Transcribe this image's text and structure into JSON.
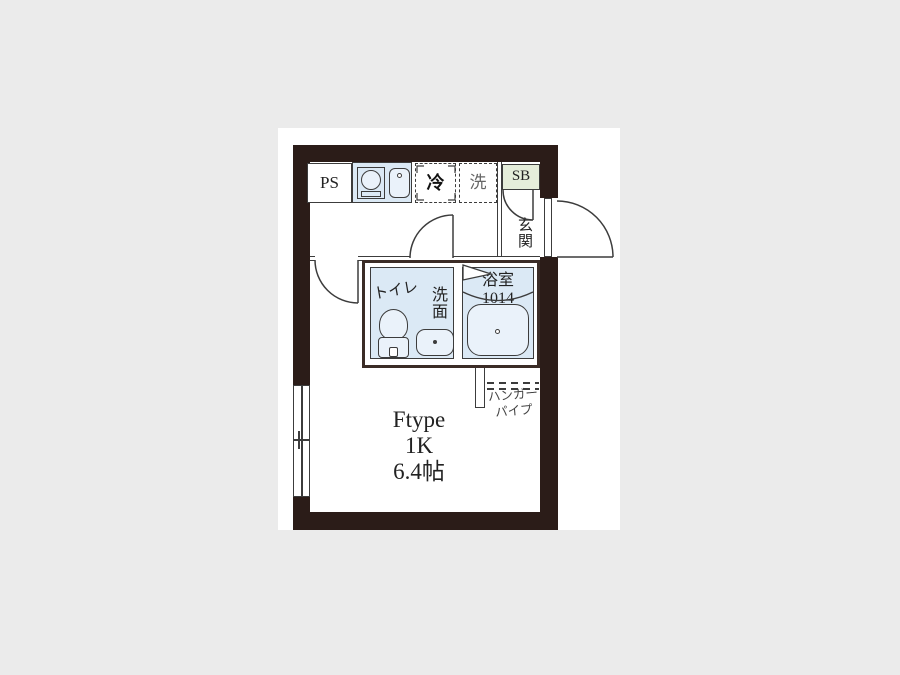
{
  "floorplan": {
    "kitchen": {
      "pipe_space": "PS",
      "refrigerator": "冷",
      "washer": "洗",
      "shoebox": "SB"
    },
    "entrance": {
      "label": "玄関"
    },
    "sanitary": {
      "toilet": "トイレ",
      "washroom": "洗面",
      "bath": "浴室",
      "bath_size": "1014"
    },
    "storage": {
      "hanger_line1": "ハンガー",
      "hanger_line2": "パイプ"
    },
    "room": {
      "type": "Ftype",
      "layout": "1K",
      "size": "6.4帖"
    },
    "colors": {
      "wall": "#2b1c18",
      "wall_light": "#3b2c26",
      "line": "#3c3c3c",
      "room_blue": "#dbe9f5",
      "fixture_blue": "#eaf2fa",
      "shoebox_green": "#e5edda",
      "page_bg": "#ebebeb",
      "text": "#222222"
    }
  }
}
